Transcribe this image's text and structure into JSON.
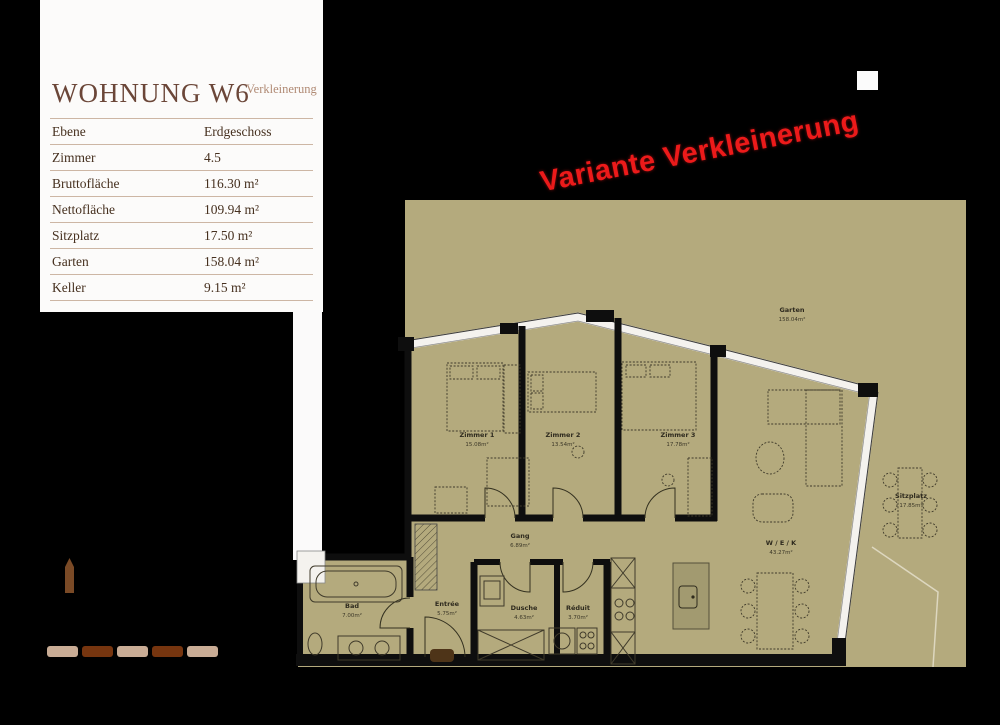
{
  "panel": {
    "title": "WOHNUNG W6",
    "subtitle": "Verkleinerung",
    "rows": [
      {
        "label": "Ebene",
        "value": "Erdgeschoss"
      },
      {
        "label": "Zimmer",
        "value": "4.5"
      },
      {
        "label": "Bruttofläche",
        "value": "116.30 m²"
      },
      {
        "label": "Nettofläche",
        "value": "109.94 m²"
      },
      {
        "label": "Sitzplatz",
        "value": "17.50 m²"
      },
      {
        "label": "Garten",
        "value": "158.04 m²"
      },
      {
        "label": "Keller",
        "value": "9.15 m²"
      }
    ]
  },
  "stamp": {
    "text": "Variante Verkleinerung",
    "color": "#ec1a1a"
  },
  "plan": {
    "colors": {
      "floor": "#b4aa7d",
      "wall": "#0e0e0e",
      "window": "#f4f2ee",
      "island": "#a29a70"
    },
    "rooms": [
      {
        "name": "Zimmer 1",
        "area": "15.08m²"
      },
      {
        "name": "Zimmer 2",
        "area": "13.54m²"
      },
      {
        "name": "Zimmer 3",
        "area": "17.78m²"
      },
      {
        "name": "Gang",
        "area": "6.89m²"
      },
      {
        "name": "Bad",
        "area": "7.00m²"
      },
      {
        "name": "Entrée",
        "area": "5.75m²"
      },
      {
        "name": "Dusche",
        "area": "4.63m²"
      },
      {
        "name": "Réduit",
        "area": "3.70m²"
      },
      {
        "name": "W / E / K",
        "area": "43.27m²"
      },
      {
        "name": "Sitzplatz",
        "area": "17.85m²"
      },
      {
        "name": "Garten",
        "area": "158.04m²"
      }
    ]
  }
}
